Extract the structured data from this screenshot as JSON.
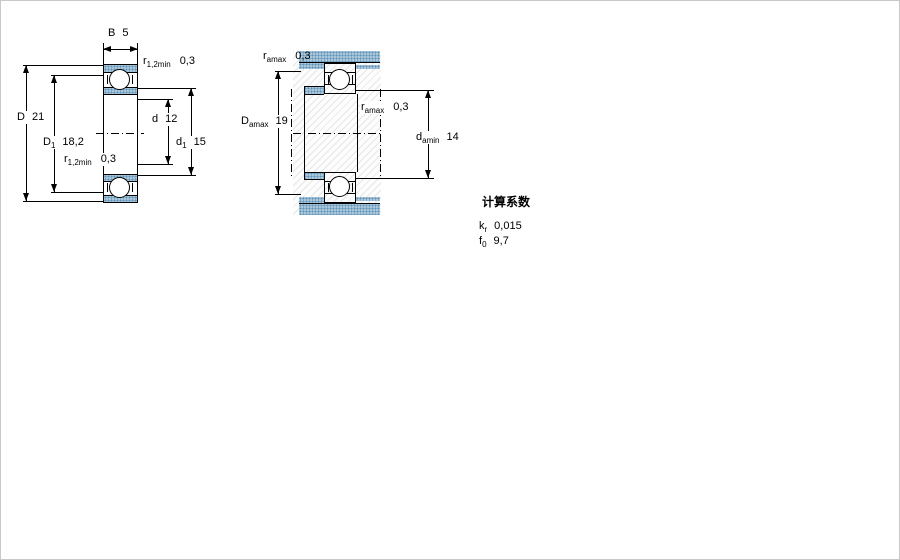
{
  "section_view": {
    "description": "bearing cross-section view",
    "dims": {
      "B": {
        "symbol": "B",
        "sub": "",
        "value": "5"
      },
      "D": {
        "symbol": "D",
        "sub": "",
        "value": "21"
      },
      "D1": {
        "symbol": "D",
        "sub": "1",
        "value": "18,2"
      },
      "d": {
        "symbol": "d",
        "sub": "",
        "value": "12"
      },
      "d1": {
        "symbol": "d",
        "sub": "1",
        "value": "15"
      },
      "r_top": {
        "symbol": "r",
        "sub": "1,2min",
        "value": "0,3"
      },
      "r_bottom": {
        "symbol": "r",
        "sub": "1,2min",
        "value": "0,3"
      }
    }
  },
  "abutment_view": {
    "description": "bearing mounting / abutment dimensions view",
    "dims": {
      "ra_top": {
        "symbol": "r",
        "sub": "amax",
        "value": "0,3"
      },
      "Da": {
        "symbol": "D",
        "sub": "amax",
        "value": "19"
      },
      "ra_mid": {
        "symbol": "r",
        "sub": "amax",
        "value": "0,3"
      },
      "da": {
        "symbol": "d",
        "sub": "amin",
        "value": "14"
      }
    }
  },
  "calculation_factors": {
    "title": "计算系数",
    "rows": [
      {
        "symbol": "k",
        "sub": "r",
        "value": "0,015"
      },
      {
        "symbol": "f",
        "sub": "0",
        "value": "9,7"
      }
    ]
  },
  "colors": {
    "shading_blue": "#a9c6da",
    "shading_dot": "#5f93b6",
    "line": "#000000"
  }
}
